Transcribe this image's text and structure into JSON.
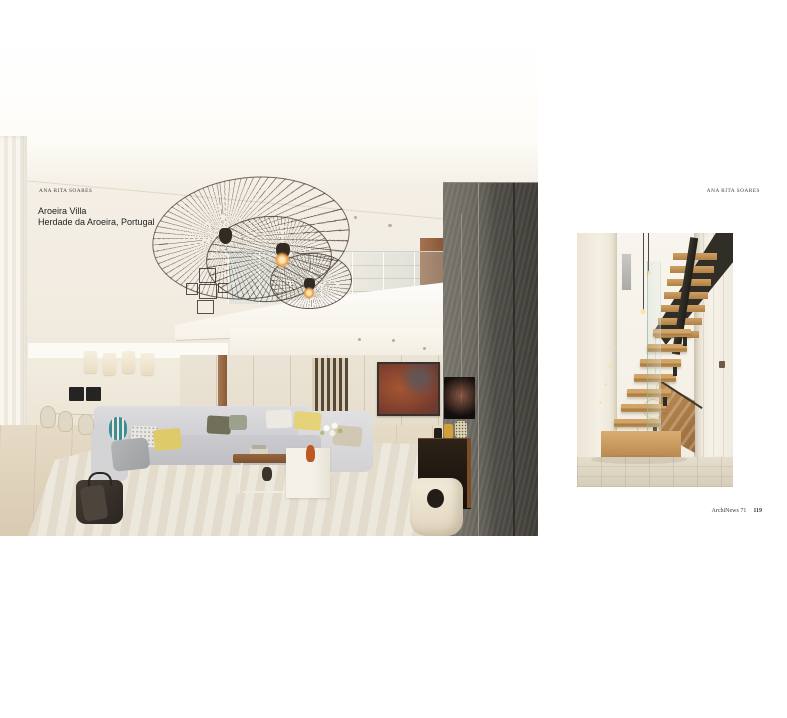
{
  "magazine": {
    "left_page": {
      "byline": "ANA RITA SOARES",
      "project_title": "Aroeira Villa",
      "project_location": "Herdade da Aroeira, Portugal"
    },
    "right_page": {
      "byline": "ANA RITA SOARES",
      "footer_magazine": "ArchiNews 71",
      "footer_page": "119"
    },
    "palette": {
      "page_background": "#ffffff",
      "stone_wall": "#55524c",
      "oak_wood": "#c89a5e",
      "painting_rust": "#8a4530",
      "sofa_grey": "#c9c9cc",
      "cushion_yellow": "#dfca68",
      "stool_teal": "#3e8d95"
    }
  }
}
